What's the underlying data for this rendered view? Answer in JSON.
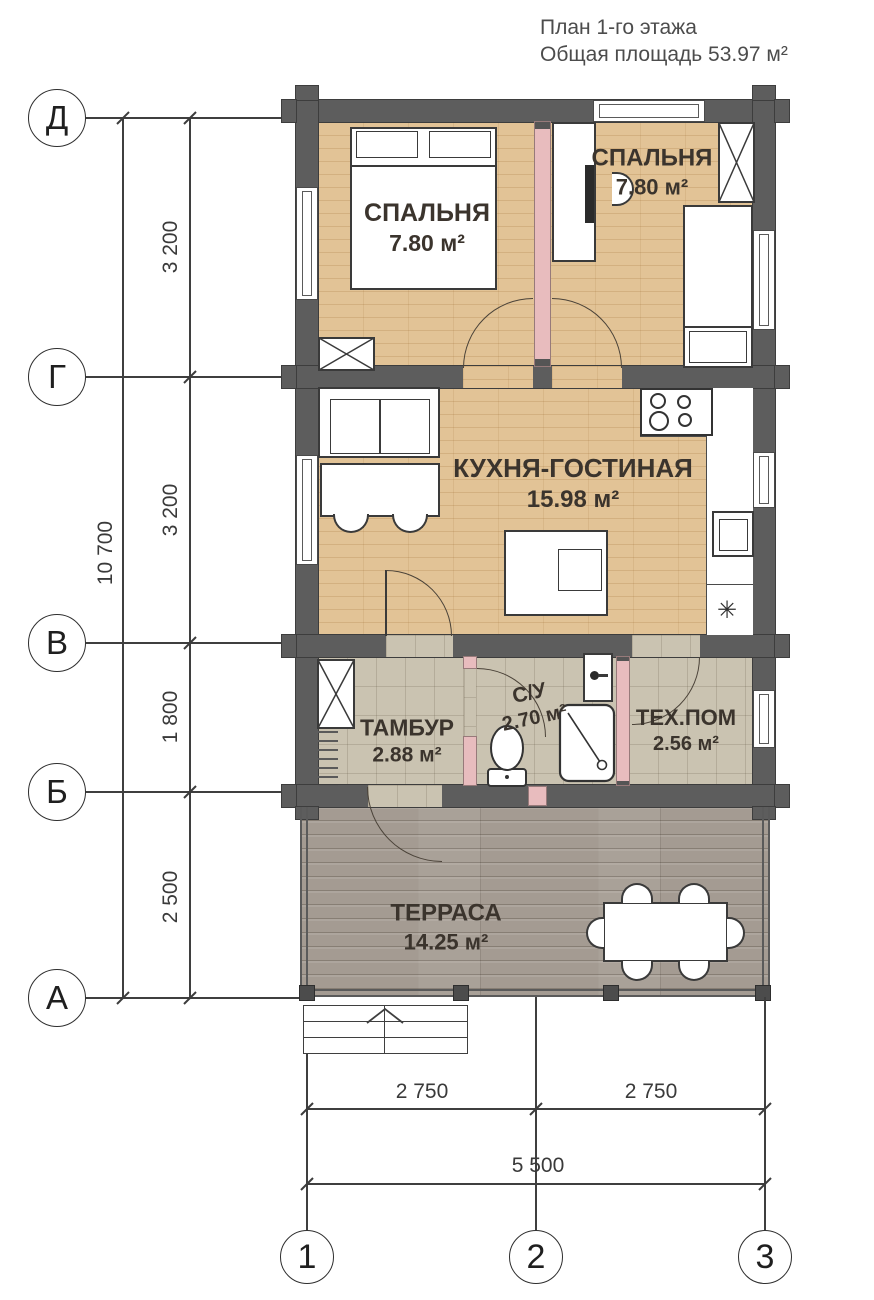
{
  "title": {
    "line1": "План 1-го этажа",
    "line2": "Общая площадь 53.97 м²"
  },
  "rooms": {
    "bedroom_left": {
      "name": "СПАЛЬНЯ",
      "area": "7.80 м²"
    },
    "bedroom_right": {
      "name": "СПАЛЬНЯ",
      "area": "7.80 м²"
    },
    "kitchen_living": {
      "name": "КУХНЯ-ГОСТИНАЯ",
      "area": "15.98 м²"
    },
    "tambour": {
      "name": "ТАМБУР",
      "area": "2.88 м²"
    },
    "bathroom": {
      "name": "С/У",
      "area": "2.70 м²"
    },
    "tech_room": {
      "name": "ТЕХ.ПОМ",
      "area": "2.56 м²"
    },
    "terrace": {
      "name": "ТЕРРАСА",
      "area": "14.25 м²"
    }
  },
  "axes": {
    "rows": [
      "Д",
      "Г",
      "В",
      "Б",
      "А"
    ],
    "cols": [
      "1",
      "2",
      "3"
    ]
  },
  "dims": {
    "v_total": "10 700",
    "v_segments": [
      "3 200",
      "3 200",
      "1 800",
      "2 500"
    ],
    "h_segments": [
      "2 750",
      "2 750"
    ],
    "h_total": "5 500"
  },
  "symbols": {
    "fridge": "✳"
  },
  "colors": {
    "wall": "#5d5d5d",
    "wood": "#e2c396",
    "tile": "#cac3b1",
    "terrace": "#a49b92",
    "partition": "#e8bcbe"
  }
}
